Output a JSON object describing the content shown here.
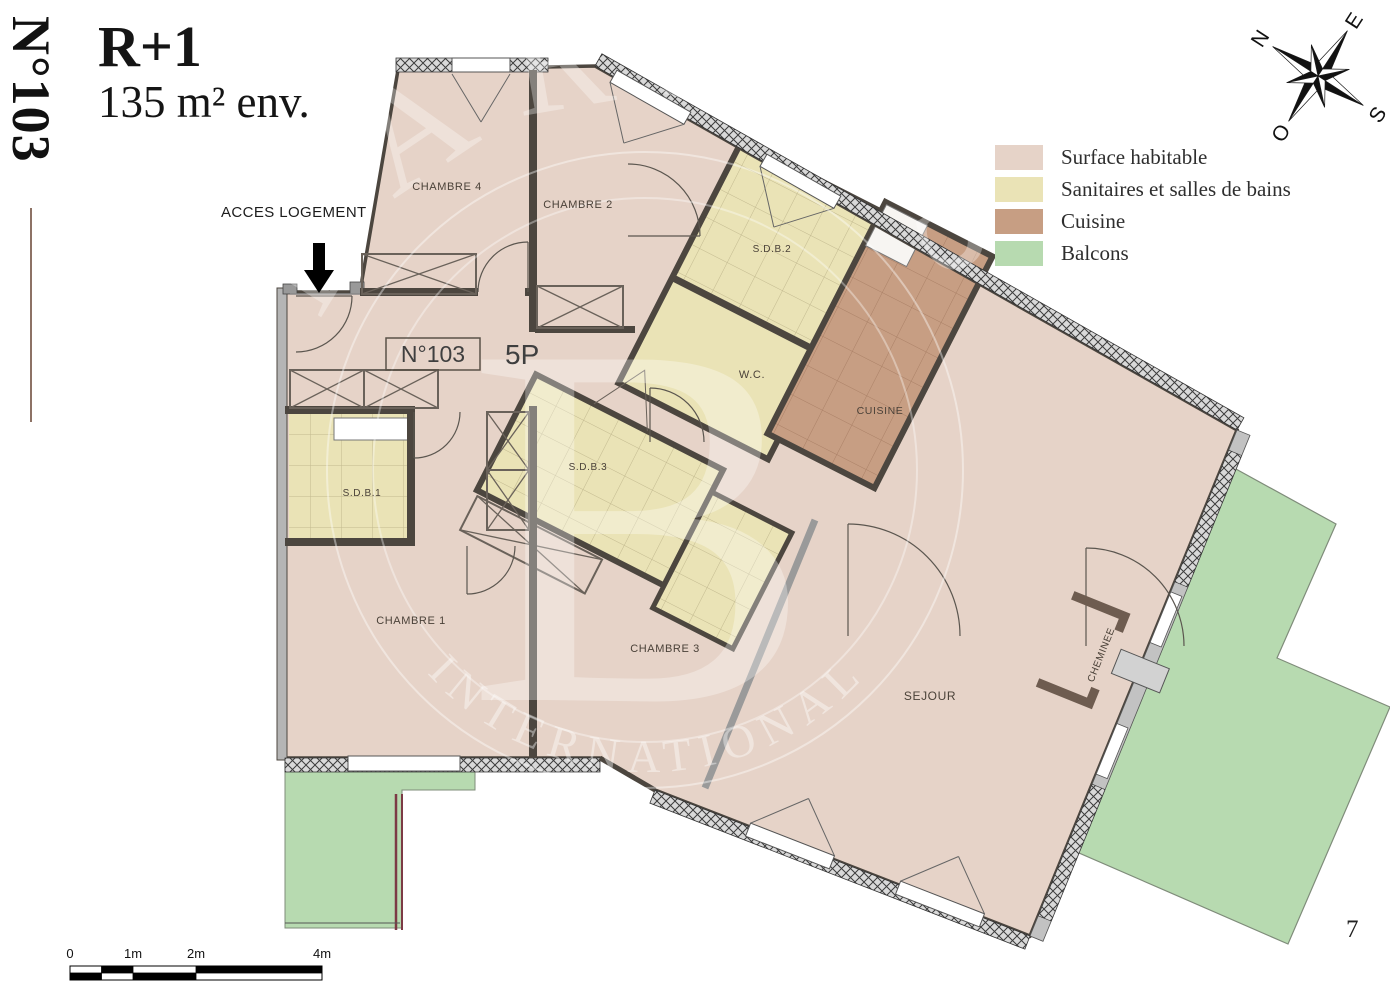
{
  "header": {
    "unit": "N°103",
    "floor": "R+1",
    "area": "135 m² env."
  },
  "access_label": "ACCES LOGEMENT",
  "unit_box": {
    "number": "N°103",
    "type": "5P"
  },
  "rooms": {
    "chambre1": "CHAMBRE 1",
    "chambre2": "CHAMBRE 2",
    "chambre3": "CHAMBRE 3",
    "chambre4": "CHAMBRE 4",
    "sdb1": "S.D.B.1",
    "sdb2": "S.D.B.2",
    "sdb3": "S.D.B.3",
    "wc": "W.C.",
    "cuisine": "CUISINE",
    "sejour": "SEJOUR",
    "cheminee": "CHEMINEE"
  },
  "legend": {
    "items": [
      {
        "label": "Surface habitable",
        "color": "#e6d3c8"
      },
      {
        "label": "Sanitaires et salles de bains",
        "color": "#eae3b6"
      },
      {
        "label": "Cuisine",
        "color": "#c79e83"
      },
      {
        "label": "Balcons",
        "color": "#b7dab0"
      }
    ]
  },
  "compass": {
    "n": "N",
    "e": "E",
    "s": "S",
    "o": "O"
  },
  "scale_bar": {
    "ticks": [
      "0",
      "1m",
      "2m",
      "4m"
    ]
  },
  "watermark": {
    "arc_top": "BARNES",
    "monogram": "B",
    "arc_bottom": "INTERNATIONAL"
  },
  "page_number": "7",
  "colors": {
    "surface_habitable": "#e6d3c8",
    "sanitaires": "#eae3b6",
    "cuisine": "#c79e83",
    "balcons": "#b7dab0",
    "walls": "#4c463f",
    "railing": "#7c3a45"
  }
}
